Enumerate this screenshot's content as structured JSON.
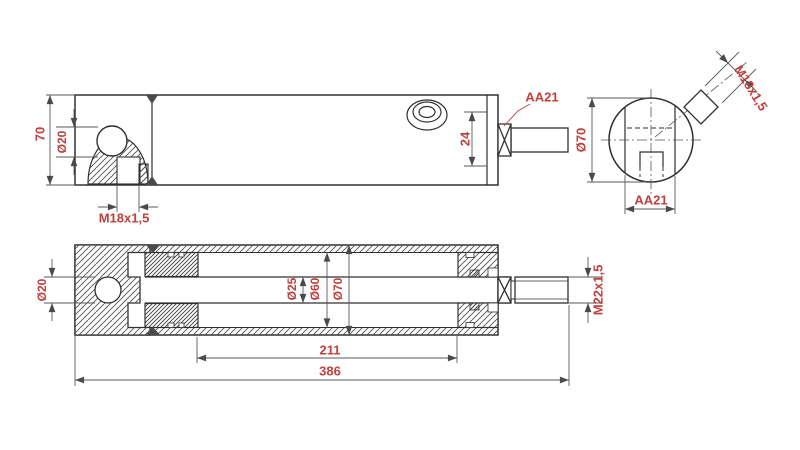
{
  "drawing": {
    "type": "technical-drawing",
    "subject": "hydraulic cylinder - 3 view engineering drawing",
    "colors": {
      "dimension_text": "#c0403c",
      "line": "#303030",
      "dim_line": "#5a5a5a",
      "background": "#ffffff"
    },
    "views": {
      "side_view": {
        "labels": {
          "height": "70",
          "pin_bore": "Ø20",
          "bottom_thread": "M18x1,5",
          "port_offset": "24",
          "rod_bearing": "AA21"
        }
      },
      "end_view": {
        "labels": {
          "outer_dia": "Ø70",
          "port_thread": "M18x1,5",
          "across_flats": "AA21"
        }
      },
      "section_view": {
        "labels": {
          "pin_bore": "Ø20",
          "rod_dia": "Ø25",
          "bore_dia": "Ø60",
          "outer_dia": "Ø70",
          "rod_thread": "M22x1,5",
          "stroke_length": "211",
          "overall_length": "386"
        }
      }
    }
  }
}
